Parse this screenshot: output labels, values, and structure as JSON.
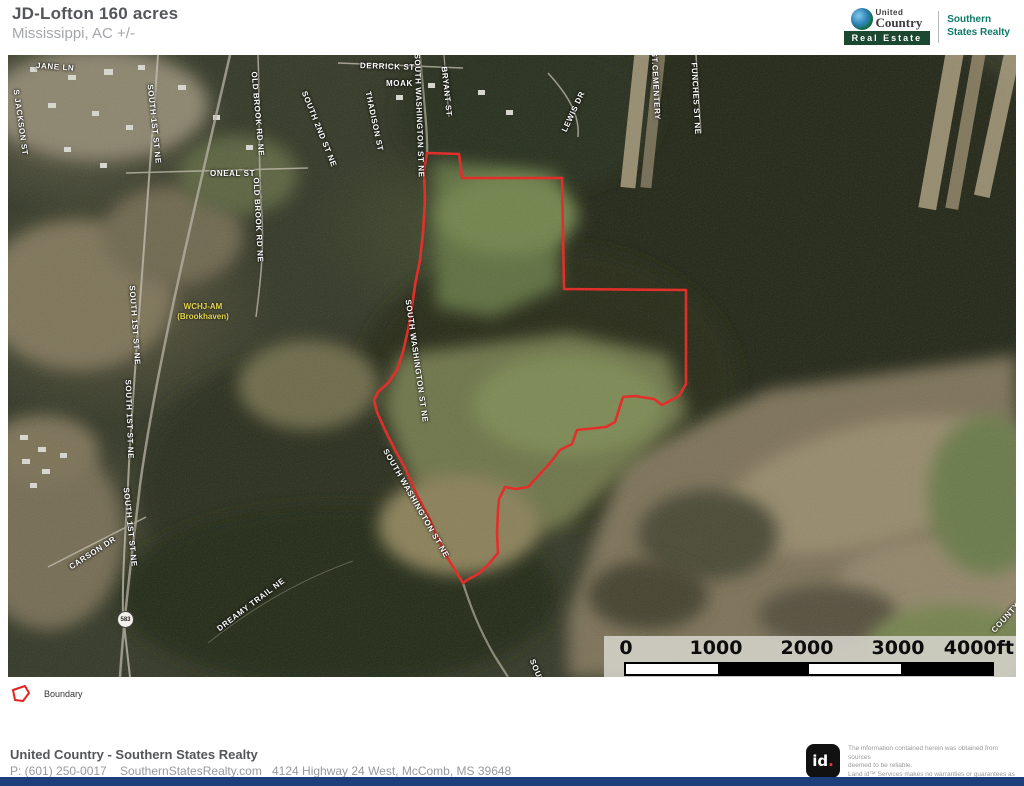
{
  "header": {
    "title": "JD-Lofton 160 acres",
    "subtitle": "Mississippi,  AC +/-"
  },
  "brand": {
    "united": "United",
    "country": "Country",
    "real_estate": "Real Estate",
    "partner_line1": "Southern",
    "partner_line2": "States Realty"
  },
  "map": {
    "street_labels": [
      "JANE LN",
      "S JACKSON ST",
      "SOUTH 1ST ST NE",
      "OLD BROOK RD NE",
      "SOUTH 2ND ST NE",
      "ONEAL ST",
      "OLD BROOK RD NE",
      "DERRICK ST",
      "MOAK",
      "THADISON ST",
      "SOUTH WASHINGTON ST NE",
      "BRYANT ST",
      "LEWIS DR",
      "ST.CEMENTERY",
      "FUNCHES ST NE",
      "SOUTH 1ST ST NE",
      "SOUTH WASHINGTON ST NE",
      "SOUTH 1ST ST NE",
      "SOUTH WASHINGTON ST NE",
      "CARSON DR",
      "SOUTH 1ST ST NE",
      "DREAMY TRAIL NE",
      "SOUTH WA",
      "COUNTY"
    ],
    "poi_label_line1": "WCHJ-AM",
    "poi_label_line2": "(Brookhaven)",
    "highway_shield": "583",
    "scale_bar": {
      "ticks": [
        "0",
        "1000",
        "2000",
        "3000"
      ],
      "end_label": "4000ft"
    },
    "boundary_color": "#e52420"
  },
  "legend": {
    "boundary_label": "Boundary"
  },
  "footer": {
    "company": "United Country - Southern States Realty",
    "phone": "P: (601) 250-0017",
    "website": "SouthernStatesRealty.com",
    "address": "4124 Highway 24 West, McComb, MS 39648",
    "logo_id": "id",
    "logo_dot": ".",
    "disclaimer_line1": "The information contained herein was obtained from sources",
    "disclaimer_line2": "deemed to be reliable.",
    "disclaimer_line3": " Land id™ Services makes no warranties or guarantees as to the",
    "disclaimer_line4": "completeness or accuracy thereof."
  },
  "colors": {
    "boundary": "#e52420",
    "bottom_bar": "#1e3d7b",
    "partner_teal": "#0e7a68",
    "real_estate_green": "#1c4731",
    "poi_yellow": "#e6d84e"
  }
}
